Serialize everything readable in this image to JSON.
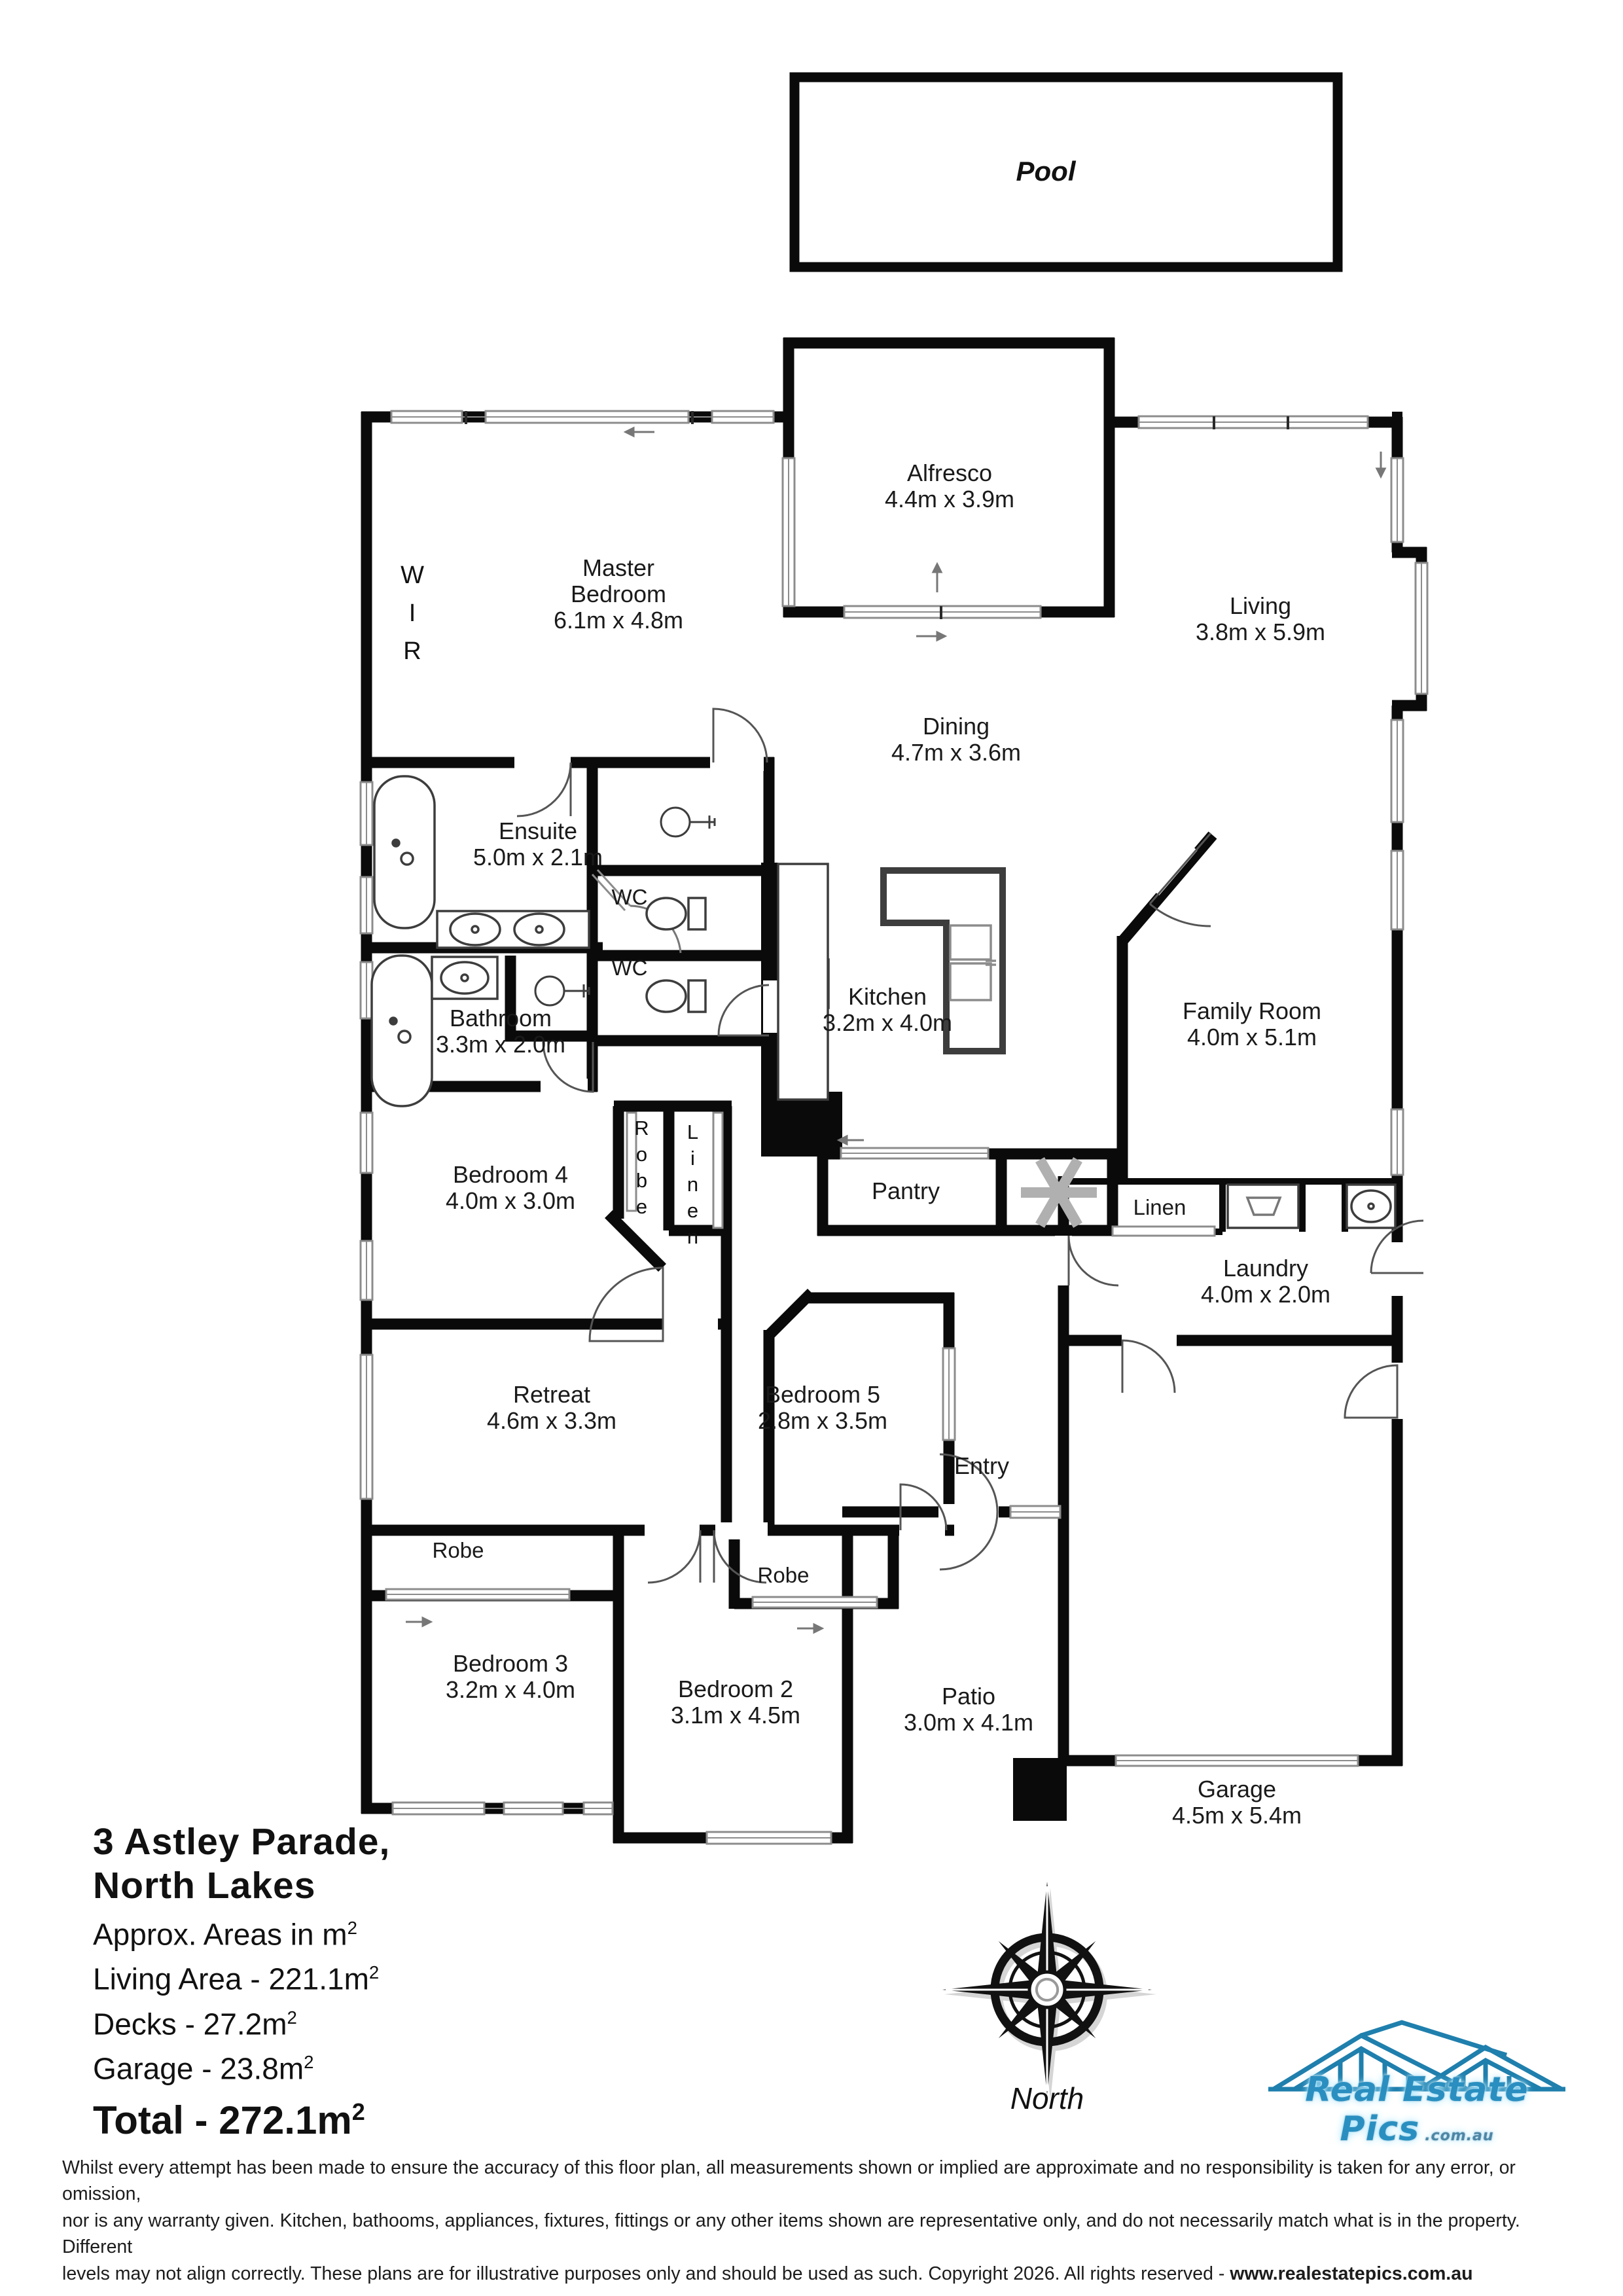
{
  "pool": {
    "label": "Pool"
  },
  "rooms": {
    "master": {
      "line1": "Master",
      "line2": "Bedroom",
      "dims": "6.1m x 4.8m"
    },
    "wir": {
      "name": "WIR"
    },
    "alfresco": {
      "name": "Alfresco",
      "dims": "4.4m x 3.9m"
    },
    "living": {
      "name": "Living",
      "dims": "3.8m x 5.9m"
    },
    "dining": {
      "name": "Dining",
      "dims": "4.7m x 3.6m"
    },
    "ensuite": {
      "name": "Ensuite",
      "dims": "5.0m x 2.1m"
    },
    "wc_upper": {
      "name": "WC"
    },
    "wc_lower": {
      "name": "WC"
    },
    "bathroom": {
      "name": "Bathroom",
      "dims": "3.3m x 2.0m"
    },
    "kitchen": {
      "name": "Kitchen",
      "dims": "3.2m x 4.0m"
    },
    "pantry": {
      "name": "Pantry"
    },
    "family": {
      "name": "Family Room",
      "dims": "4.0m x 5.1m"
    },
    "linen_laundry": {
      "name": "Linen"
    },
    "laundry": {
      "name": "Laundry",
      "dims": "4.0m x 2.0m"
    },
    "bedroom4": {
      "name": "Bedroom 4",
      "dims": "4.0m x 3.0m"
    },
    "robe_hall": {
      "name": "Robe"
    },
    "linen_hall": {
      "name": "Linen"
    },
    "retreat": {
      "name": "Retreat",
      "dims": "4.6m x 3.3m"
    },
    "bedroom5": {
      "name": "Bedroom 5",
      "dims": "2.8m x 3.5m"
    },
    "entry": {
      "name": "Entry"
    },
    "robe_bed3": {
      "name": "Robe"
    },
    "robe_bed2": {
      "name": "Robe"
    },
    "bedroom3": {
      "name": "Bedroom 3",
      "dims": "3.2m x 4.0m"
    },
    "bedroom2": {
      "name": "Bedroom 2",
      "dims": "3.1m x 4.5m"
    },
    "patio": {
      "name": "Patio",
      "dims": "3.0m x 4.1m"
    },
    "garage": {
      "name": "Garage",
      "dims": "4.5m x 5.4m"
    }
  },
  "summary": {
    "address_line1": "3 Astley Parade,",
    "address_line2": "North Lakes",
    "areas_label": "Approx. Areas in m",
    "living_label": "Living Area - 221.1m",
    "decks_label": "Decks - 27.2m",
    "garage_label": "Garage - 23.8m",
    "total_label": "Total - 272.1m",
    "sup": "2"
  },
  "compass": {
    "label": "North"
  },
  "logo": {
    "text": "Real Estate Pics",
    "suffix": ".com.au",
    "blue": "#1f7fad"
  },
  "disclaimer": {
    "line1": "Whilst every attempt has been made to ensure the accuracy of this floor plan, all measurements shown or implied are approximate and no responsibility is taken for any error, or omission,",
    "line2": "nor is any warranty given.  Kitchen, bathooms, appliances, fixtures, fittings or any  other items shown  are representative only, and do not necessarily match what is in the property.  Different",
    "line3": "levels may not align correctly.  These plans are for illustrative purposes only and should be used as such.  Copyright 2026.  All rights reserved - ",
    "link": "www.realestatepics.com.au"
  }
}
